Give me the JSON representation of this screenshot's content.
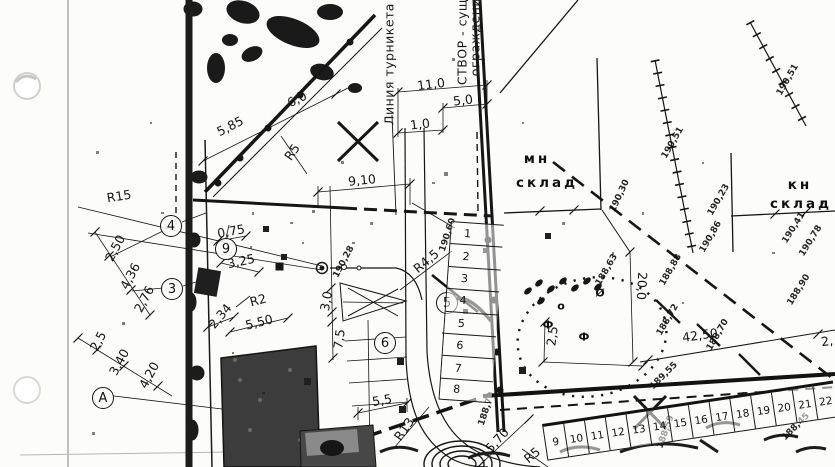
{
  "plan": {
    "rotated_texts": [
      {
        "text": "Линия турникета",
        "x": 389,
        "y": 64,
        "rot": -90
      },
      {
        "text": "СТВОР - сущ",
        "x": 462,
        "y": 42,
        "rot": -90
      },
      {
        "text": "ограждение",
        "x": 475,
        "y": 33,
        "rot": -90
      }
    ],
    "building_labels": [
      {
        "text": "мн",
        "x": 537,
        "y": 159
      },
      {
        "text": "склад",
        "x": 547,
        "y": 183
      },
      {
        "text": "кн",
        "x": 800,
        "y": 185
      },
      {
        "text": "склад",
        "x": 801,
        "y": 204
      }
    ],
    "dimension_labels": [
      {
        "text": "5,85",
        "x": 230,
        "y": 126,
        "rot": -27
      },
      {
        "text": "6,0",
        "x": 297,
        "y": 99,
        "rot": -27
      },
      {
        "text": "11,0",
        "x": 431,
        "y": 84,
        "rot": -7
      },
      {
        "text": "5,0",
        "x": 463,
        "y": 100,
        "rot": -7
      },
      {
        "text": "1,0",
        "x": 420,
        "y": 124,
        "rot": -7
      },
      {
        "text": "9,10",
        "x": 362,
        "y": 180,
        "rot": -6
      },
      {
        "text": "R15",
        "x": 119,
        "y": 196,
        "rot": -9
      },
      {
        "text": "R5",
        "x": 292,
        "y": 152,
        "rot": -55
      },
      {
        "text": "0,75",
        "x": 231,
        "y": 231,
        "rot": -10
      },
      {
        "text": "3,25",
        "x": 241,
        "y": 261,
        "rot": -12
      },
      {
        "text": "2,50",
        "x": 115,
        "y": 248,
        "rot": -62
      },
      {
        "text": "4,36",
        "x": 130,
        "y": 276,
        "rot": -62
      },
      {
        "text": "2,76",
        "x": 144,
        "y": 299,
        "rot": -62
      },
      {
        "text": "2,5",
        "x": 98,
        "y": 341,
        "rot": -62
      },
      {
        "text": "3,40",
        "x": 119,
        "y": 362,
        "rot": -62
      },
      {
        "text": "4,20",
        "x": 149,
        "y": 375,
        "rot": -62
      },
      {
        "text": "R2",
        "x": 258,
        "y": 300,
        "rot": -15
      },
      {
        "text": "5,50",
        "x": 259,
        "y": 322,
        "rot": -14
      },
      {
        "text": "2,34",
        "x": 220,
        "y": 316,
        "rot": -50
      },
      {
        "text": "3,0",
        "x": 326,
        "y": 301,
        "rot": -80
      },
      {
        "text": "7,5",
        "x": 339,
        "y": 339,
        "rot": -82
      },
      {
        "text": "R4,5",
        "x": 426,
        "y": 261,
        "rot": -40
      },
      {
        "text": "5,5",
        "x": 382,
        "y": 400,
        "rot": -10
      },
      {
        "text": "R13",
        "x": 404,
        "y": 429,
        "rot": -55
      },
      {
        "text": "5,70",
        "x": 497,
        "y": 440,
        "rot": -48
      },
      {
        "text": "R5",
        "x": 532,
        "y": 455,
        "rot": -40
      },
      {
        "text": "20,0",
        "x": 642,
        "y": 286,
        "rot": 93
      },
      {
        "text": "42,50",
        "x": 700,
        "y": 335,
        "rot": -8
      },
      {
        "text": "2,",
        "x": 827,
        "y": 341,
        "rot": -8
      },
      {
        "text": "2,5",
        "x": 552,
        "y": 336,
        "rot": -83
      }
    ],
    "elevation_marks": [
      {
        "text": "190,30",
        "x": 620,
        "y": 196,
        "rot": -65
      },
      {
        "text": "190,23",
        "x": 719,
        "y": 200,
        "rot": -60
      },
      {
        "text": "190,86",
        "x": 711,
        "y": 237,
        "rot": -60
      },
      {
        "text": "190,41",
        "x": 794,
        "y": 228,
        "rot": -58
      },
      {
        "text": "190,78",
        "x": 811,
        "y": 241,
        "rot": -58
      },
      {
        "text": "190,51",
        "x": 673,
        "y": 143,
        "rot": -60
      },
      {
        "text": "190,51",
        "x": 788,
        "y": 80,
        "rot": -60
      },
      {
        "text": "188,63",
        "x": 607,
        "y": 270,
        "rot": -60
      },
      {
        "text": "188,88",
        "x": 671,
        "y": 270,
        "rot": -60
      },
      {
        "text": "188,72",
        "x": 668,
        "y": 320,
        "rot": -60
      },
      {
        "text": "188,70",
        "x": 718,
        "y": 335,
        "rot": -60
      },
      {
        "text": "188,90",
        "x": 799,
        "y": 290,
        "rot": -58
      },
      {
        "text": "189,55",
        "x": 664,
        "y": 376,
        "rot": -45
      },
      {
        "text": "188,59",
        "x": 666,
        "y": 432,
        "rot": -70
      },
      {
        "text": "188,45",
        "x": 796,
        "y": 427,
        "rot": -45
      },
      {
        "text": "190,28",
        "x": 344,
        "y": 262,
        "rot": -62
      },
      {
        "text": "190,60",
        "x": 448,
        "y": 235,
        "rot": -72
      },
      {
        "text": "188,70",
        "x": 487,
        "y": 409,
        "rot": -72
      }
    ],
    "tree_symbols": [
      {
        "glyph": "Ф",
        "x": 548,
        "y": 325
      },
      {
        "glyph": "Ф",
        "x": 584,
        "y": 337
      },
      {
        "glyph": "Ø",
        "x": 600,
        "y": 293
      },
      {
        "glyph": "о",
        "x": 561,
        "y": 306
      }
    ],
    "axis_markers": [
      {
        "label": "4",
        "x": 171,
        "y": 226
      },
      {
        "label": "9",
        "x": 226,
        "y": 249
      },
      {
        "label": "3",
        "x": 172,
        "y": 289
      },
      {
        "label": "A",
        "x": 103,
        "y": 398
      },
      {
        "label": "5",
        "x": 447,
        "y": 303
      },
      {
        "label": "6",
        "x": 385,
        "y": 343
      }
    ],
    "stalls_vertical": {
      "numbers": [
        "1",
        "2",
        "3",
        "4",
        "5",
        "6",
        "7",
        "8"
      ]
    },
    "stalls_horizontal": {
      "numbers": [
        "9",
        "10",
        "11",
        "12",
        "13",
        "14",
        "15",
        "16",
        "17",
        "18",
        "19",
        "20",
        "21",
        "22"
      ]
    },
    "colors": {
      "ink": "#161616",
      "paper": "#fcfcfb"
    }
  }
}
